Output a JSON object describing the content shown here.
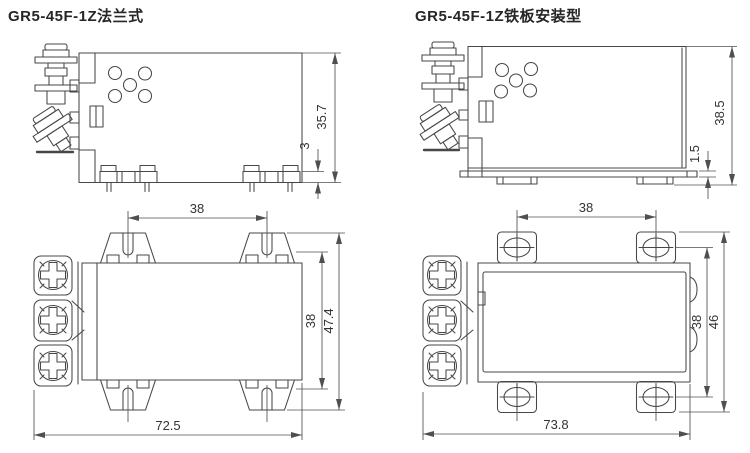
{
  "figures": {
    "flange": {
      "title": "GR5-45F-1Z法兰式",
      "dims": {
        "total_height": "35.7",
        "pin_seat_height": "3",
        "slot_spacing": "38",
        "vertical_span": "38",
        "overall_height": "47.4",
        "overall_width": "72.5"
      }
    },
    "plate": {
      "title": "GR5-45F-1Z铁板安装型",
      "dims": {
        "total_height": "38.5",
        "plate_thickness": "1.5",
        "hole_spacing": "38",
        "vertical_span": "38",
        "tab_span": "46",
        "overall_width": "73.8"
      }
    }
  },
  "colors": {
    "background": "#ffffff",
    "line": "#474747",
    "dimension_line": "#4f4f4f",
    "dimension_text": "#333333",
    "title_text": "#262626"
  }
}
